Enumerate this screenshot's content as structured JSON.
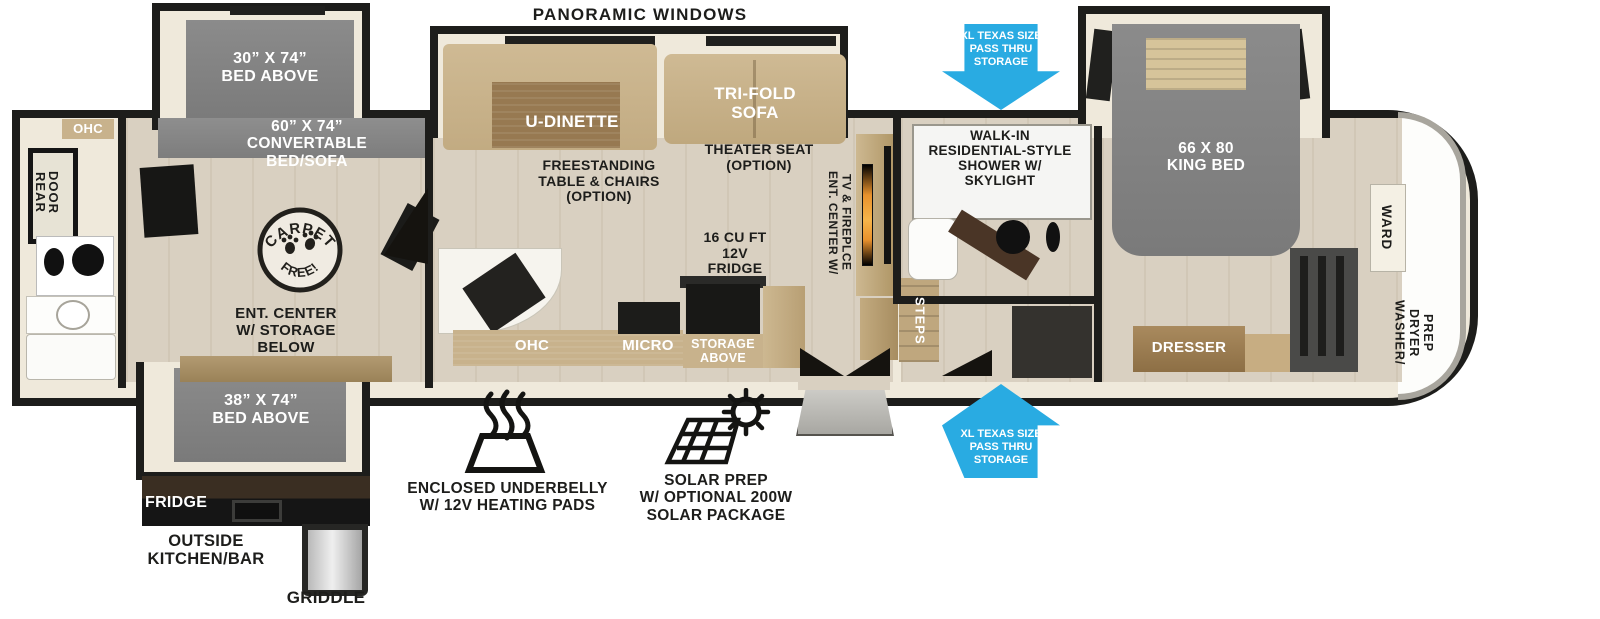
{
  "title": "Fifth Wheel RV Floorplan",
  "colors": {
    "arrow_blue": "#29abe2",
    "wall_black": "#1d1d1b",
    "slide_gray": "#828282",
    "furniture_tan": "#c8b28c",
    "floor_wood": "#d9d0c1",
    "cabinet_brown": "#9a7b52",
    "fireplace_orange": "#e8912c"
  },
  "icons": {
    "pass_thru_top": "down-arrow-icon",
    "pass_thru_bottom": "up-arrow-icon",
    "underbelly": "heat-waves-icon",
    "solar": "solar-panel-sun-icon",
    "carpet_free": "carpet-free-stamp-icon"
  },
  "labels": {
    "panoramic_windows": "PANORAMIC WINDOWS",
    "bed_30x74": "30” X 74”\nBED ABOVE",
    "convertable_bed": "60” X 74”\nCONVERTABLE\nBED/SOFA",
    "bed_38x74": "38” X 74”\nBED ABOVE",
    "king_bed": "66 X 80\nKING BED",
    "ohc_rear": "OHC",
    "rear_door": "REAR\nDOOR",
    "carpet_free_top": "CARPET",
    "carpet_free_bottom": "FREE!",
    "ent_center_storage": "ENT. CENTER\nW/ STORAGE\nBELOW",
    "outside_fridge": "FRIDGE",
    "outside_kitchen": "OUTSIDE\nKITCHEN/BAR",
    "griddle": "GRIDDLE",
    "u_dinette": "U-DINETTE",
    "freestanding_table": "FREESTANDING\nTABLE & CHAIRS\n(OPTION)",
    "tri_fold_sofa": "TRI-FOLD\nSOFA",
    "theater_seat": "THEATER SEAT\n(OPTION)",
    "fridge_16": "16 CU FT\n12V\nFRIDGE",
    "storage_above": "STORAGE\nABOVE",
    "ohc_kitchen": "OHC",
    "micro": "MICRO",
    "ent_center_tv": "ENT. CENTER W/\nTV & FIREPLCE",
    "steps": "STEPS",
    "walk_in_shower": "WALK-IN\nRESIDENTIAL-STYLE\nSHOWER W/\nSKYLIGHT",
    "pass_thru_top": "XL TEXAS SIZE\nPASS THRU\nSTORAGE",
    "pass_thru_bottom": "XL TEXAS SIZE\nPASS THRU\nSTORAGE",
    "dresser": "DRESSER",
    "ward": "WARD",
    "washer_dryer_prep": "WASHER/\nDRYER\nPREP",
    "enclosed_underbelly": "ENCLOSED UNDERBELLY\nW/ 12V HEATING PADS",
    "solar_prep": "SOLAR PREP\nW/ OPTIONAL 200W\nSOLAR PACKAGE"
  }
}
